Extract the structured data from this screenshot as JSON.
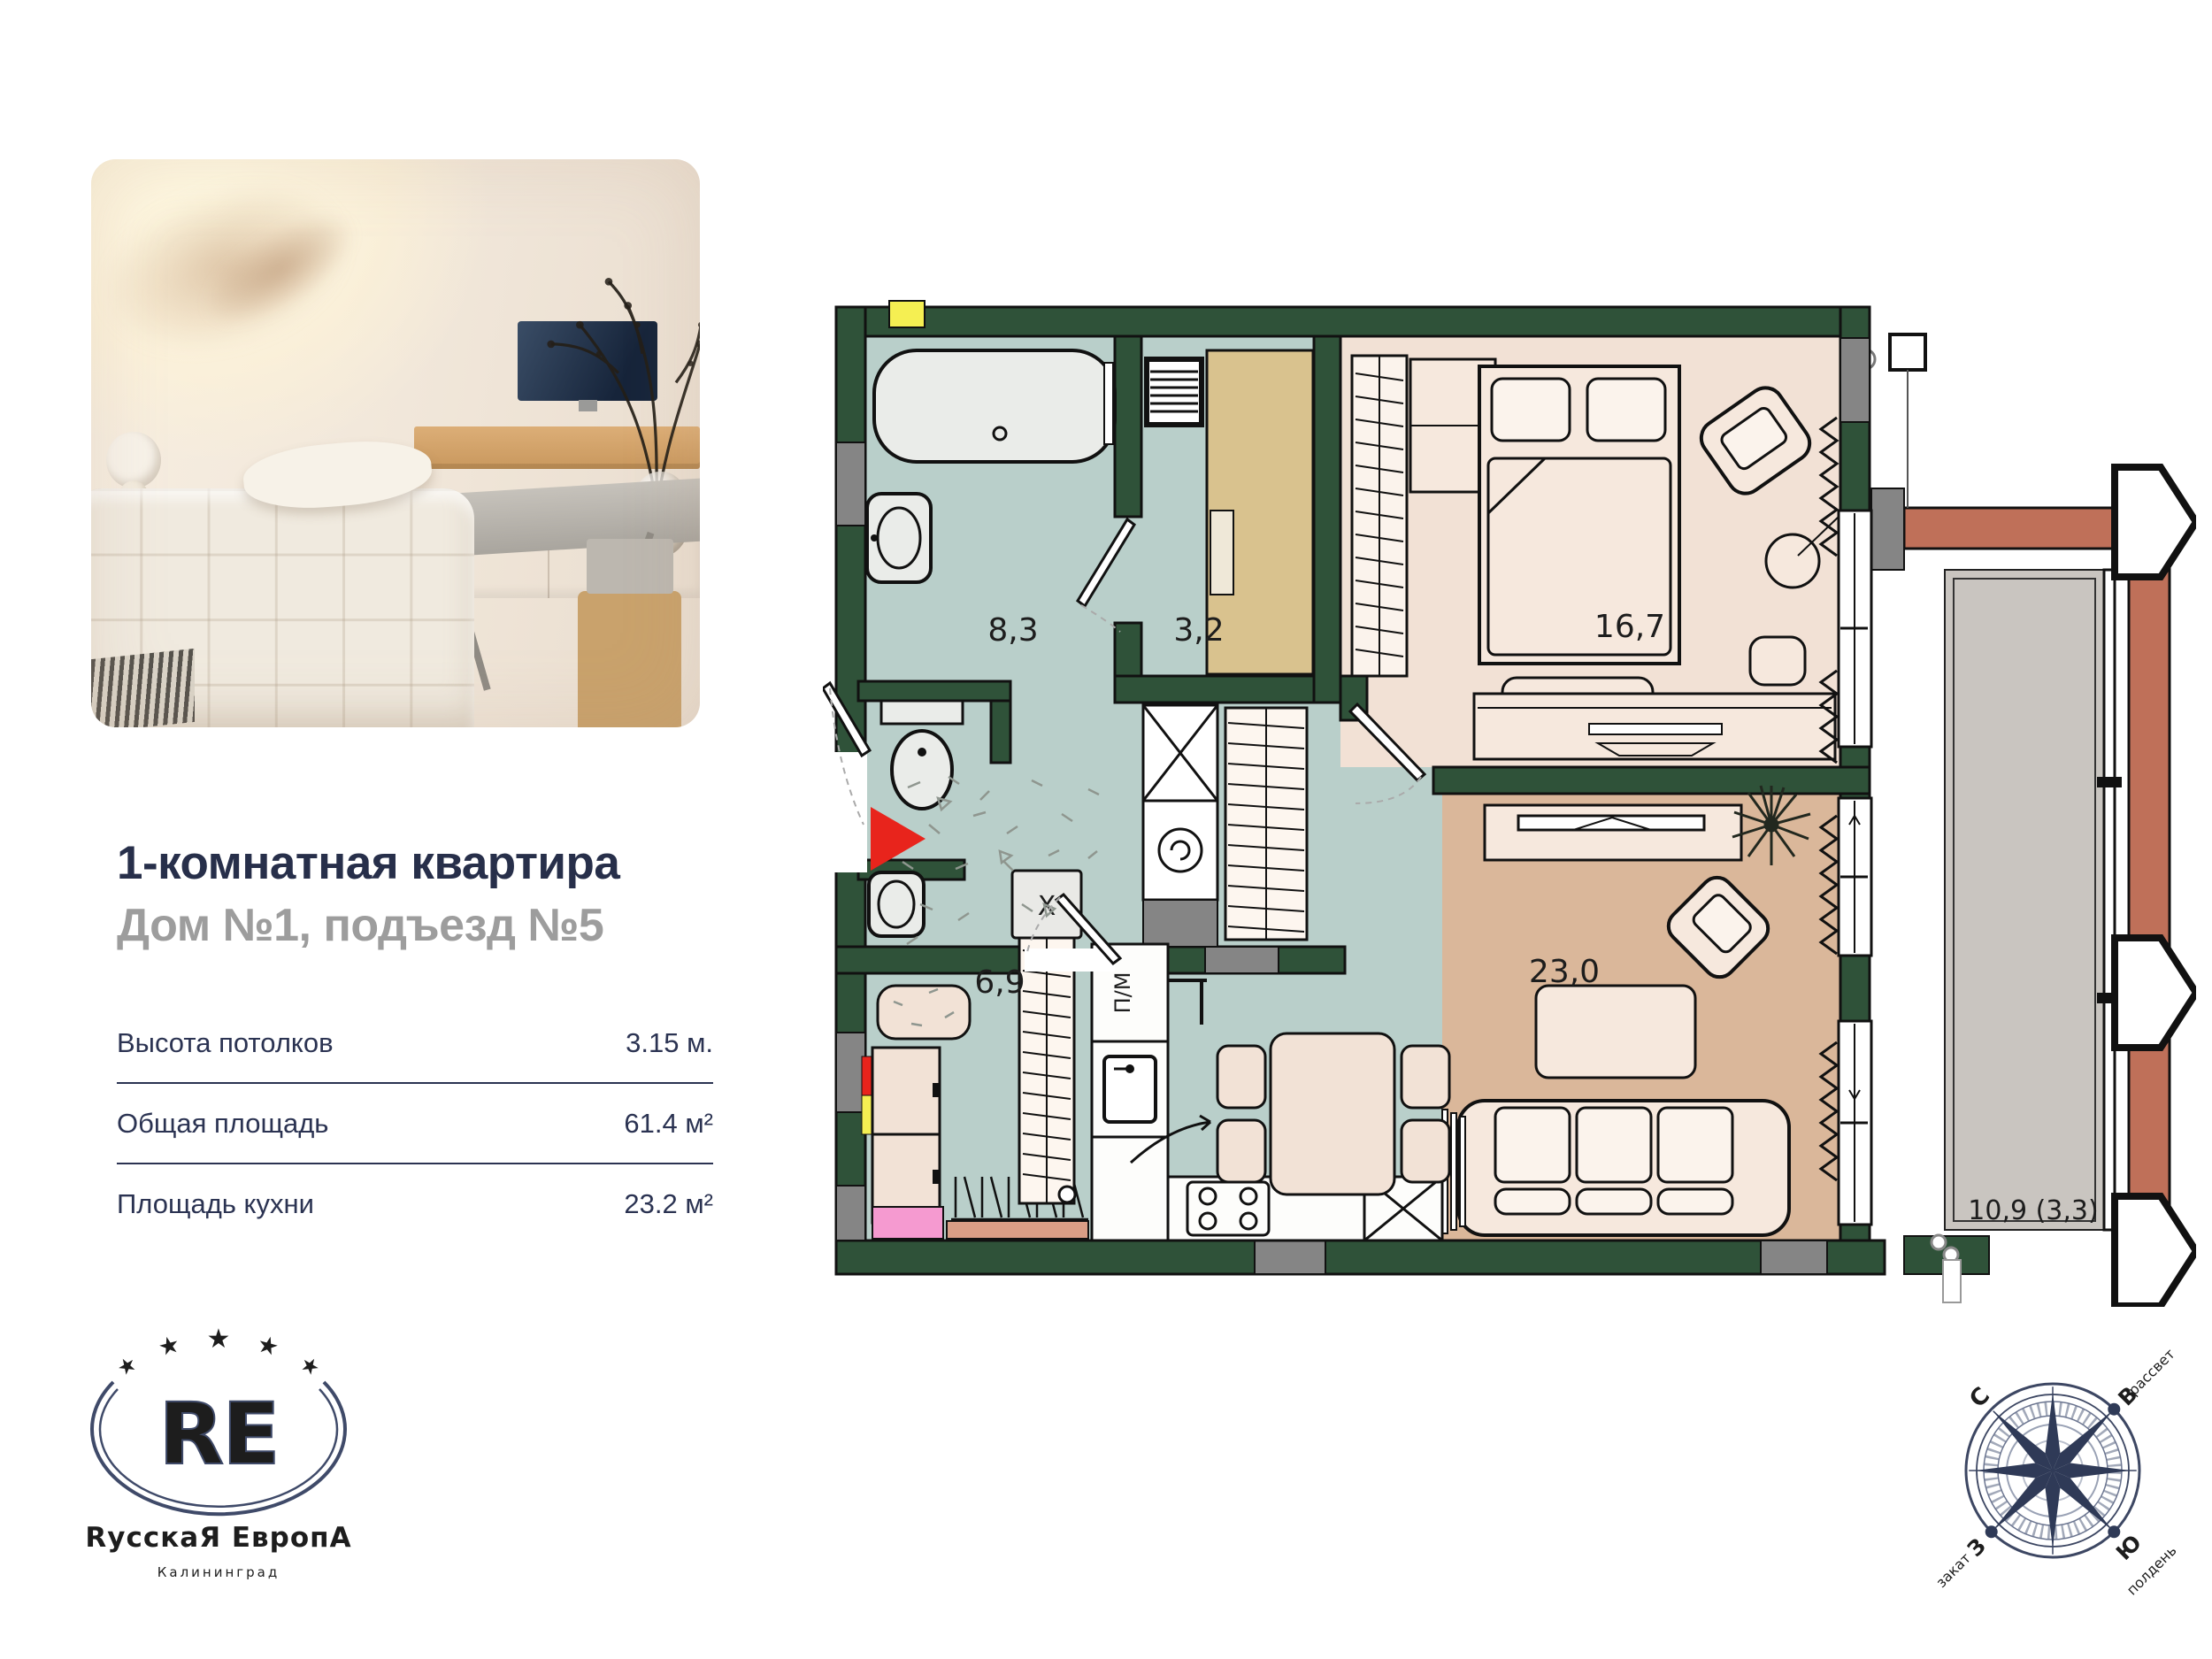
{
  "listing": {
    "title": "1-комнатная квартира",
    "subtitle": "Дом №1, подъезд №5",
    "specs": [
      {
        "label": "Высота потолков",
        "value": "3.15 м."
      },
      {
        "label": "Общая площадь",
        "value": "61.4 м²"
      },
      {
        "label": "Площадь кухни",
        "value": "23.2 м²"
      }
    ]
  },
  "logo": {
    "monogram": "RE",
    "name": "RусскаЯ ЕвропА",
    "city": "Калининград",
    "star": "★",
    "color": "#3f4a69"
  },
  "plan": {
    "rooms": [
      {
        "name": "bathroom",
        "area": "8,3"
      },
      {
        "name": "dressing-room",
        "area": "3,2"
      },
      {
        "name": "bedroom",
        "area": "16,7"
      },
      {
        "name": "hallway",
        "area": "6,9"
      },
      {
        "name": "kitchen-living",
        "area": "23,0"
      },
      {
        "name": "balcony",
        "area": "10,9 (3,3)"
      }
    ],
    "labels": {
      "fridge": "X",
      "dishwasher": "П/М"
    },
    "colors": {
      "wall": "#2f5239",
      "wet-floor": "#b9cfca",
      "bedroom-floor": "#f2e1d5",
      "living-floor": "#dab79a",
      "balcony-floor": "#c9c5c0",
      "brick": "#bf7059",
      "entry-arrow": "#e8241c",
      "marker-yellow": "#f5ef52",
      "marker-pink": "#f59ad0"
    }
  },
  "compass": {
    "n": "С",
    "e": "В",
    "w": "З",
    "s": "Ю",
    "sunrise": "рассвет",
    "sunset": "закат",
    "noon": "полдень"
  }
}
